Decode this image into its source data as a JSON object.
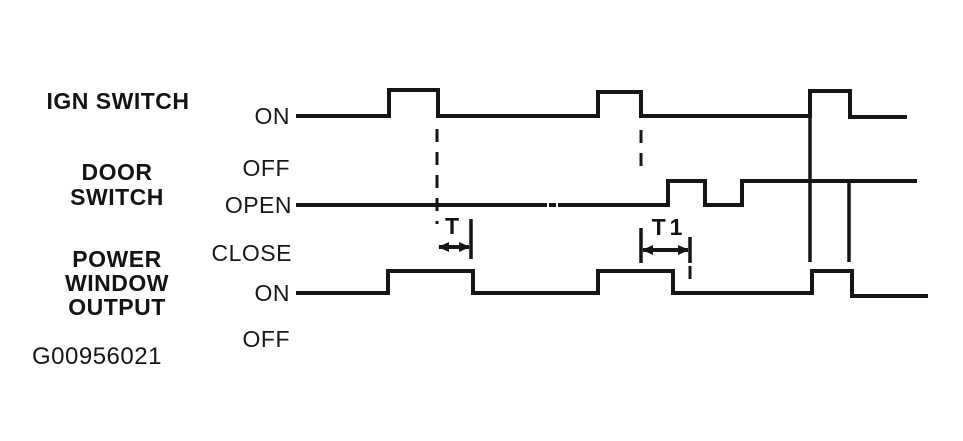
{
  "figure": {
    "background": "#ffffff",
    "line_color": "#161616",
    "id_text": "G00956021"
  },
  "labels": {
    "ign_switch": "IGN SWITCH",
    "door_switch": "DOOR\nSWITCH",
    "power_window_output": "POWER\nWINDOW\nOUTPUT",
    "ign_on": "ON",
    "ign_off": "OFF",
    "door_open": "OPEN",
    "door_close": "CLOSE",
    "pw_on": "ON",
    "pw_off": "OFF",
    "t": "T",
    "t1": "T1"
  },
  "chart_data": {
    "type": "timing-diagram",
    "title": "Power window output timing versus ignition switch and door switch",
    "signals": [
      {
        "name": "ign-switch",
        "label": "IGN SWITCH",
        "high_label": "ON",
        "low_label": "OFF",
        "high_y": 91,
        "low_y": 116,
        "on_intervals_x": [
          [
            389,
            438
          ],
          [
            598,
            641
          ],
          [
            810,
            850
          ]
        ]
      },
      {
        "name": "door-switch",
        "label": "DOOR SWITCH",
        "high_label": "OPEN",
        "low_label": "CLOSE",
        "high_y": 181,
        "low_y": 205,
        "on_intervals_x": [
          [
            668,
            705
          ],
          [
            742,
            915
          ]
        ]
      },
      {
        "name": "power-window-output",
        "label": "POWER WINDOW OUTPUT",
        "high_label": "ON",
        "low_label": "OFF",
        "high_y": 271,
        "low_y": 293,
        "on_intervals_x": [
          [
            388,
            473
          ],
          [
            598,
            673
          ],
          [
            812,
            852
          ]
        ]
      }
    ],
    "waveforms": [
      {
        "name": "ign-switch-wave",
        "segments": [
          [
            [
              298,
              116
            ],
            [
              389,
              116
            ],
            [
              389,
              90
            ],
            [
              438,
              90
            ],
            [
              438,
              116
            ],
            [
              598,
              116
            ],
            [
              598,
              92
            ],
            [
              641,
              92
            ],
            [
              641,
              116
            ],
            [
              810,
              116
            ],
            [
              810,
              91
            ],
            [
              850,
              91
            ],
            [
              850,
              117
            ],
            [
              905,
              117
            ]
          ]
        ]
      },
      {
        "name": "door-switch-wave",
        "segments": [
          [
            [
              298,
              205
            ],
            [
              545,
              205
            ]
          ],
          [
            [
              551,
              205
            ],
            [
              554,
              205
            ]
          ],
          [
            [
              560,
              205
            ],
            [
              668,
              205
            ],
            [
              668,
              181
            ],
            [
              705,
              181
            ],
            [
              705,
              205
            ],
            [
              742,
              205
            ],
            [
              742,
              181
            ],
            [
              915,
              181
            ]
          ]
        ]
      },
      {
        "name": "power-window-output-wave",
        "segments": [
          [
            [
              298,
              293
            ],
            [
              388,
              293
            ],
            [
              388,
              271
            ],
            [
              473,
              271
            ],
            [
              473,
              293
            ],
            [
              598,
              293
            ],
            [
              598,
              271
            ],
            [
              673,
              271
            ],
            [
              673,
              293
            ],
            [
              812,
              293
            ],
            [
              812,
              271
            ],
            [
              852,
              271
            ],
            [
              852,
              296
            ],
            [
              926,
              296
            ]
          ]
        ]
      }
    ],
    "reference_lines": [
      {
        "name": "align-line-last-pulse-rise",
        "x": 810,
        "y1": 93,
        "y2": 262,
        "style": "solid"
      },
      {
        "name": "align-line-last-pulse-fall",
        "x": 849,
        "y1": 182,
        "y2": 262,
        "style": "solid"
      },
      {
        "name": "dash-ign-off-edge-1",
        "x": 437,
        "y1": 129,
        "y2": 224,
        "style": "dashed"
      },
      {
        "name": "dash-ign-off-edge-2",
        "x": 641,
        "y1": 130,
        "y2": 166,
        "style": "dashed"
      },
      {
        "name": "dash-t1-right-bound",
        "x": 690,
        "y1": 266,
        "y2": 289,
        "style": "dashed"
      }
    ],
    "measurements": [
      {
        "name": "measure-t",
        "label": "T",
        "arrow_y": 247,
        "x1": 437,
        "x2": 471,
        "bars": [
          [
            471,
            219,
            259
          ]
        ]
      },
      {
        "name": "measure-t1",
        "label": "T1",
        "arrow_y": 250,
        "x1": 641,
        "x2": 690,
        "bars": [
          [
            641,
            228,
            263
          ],
          [
            690,
            237,
            263
          ]
        ]
      }
    ]
  }
}
